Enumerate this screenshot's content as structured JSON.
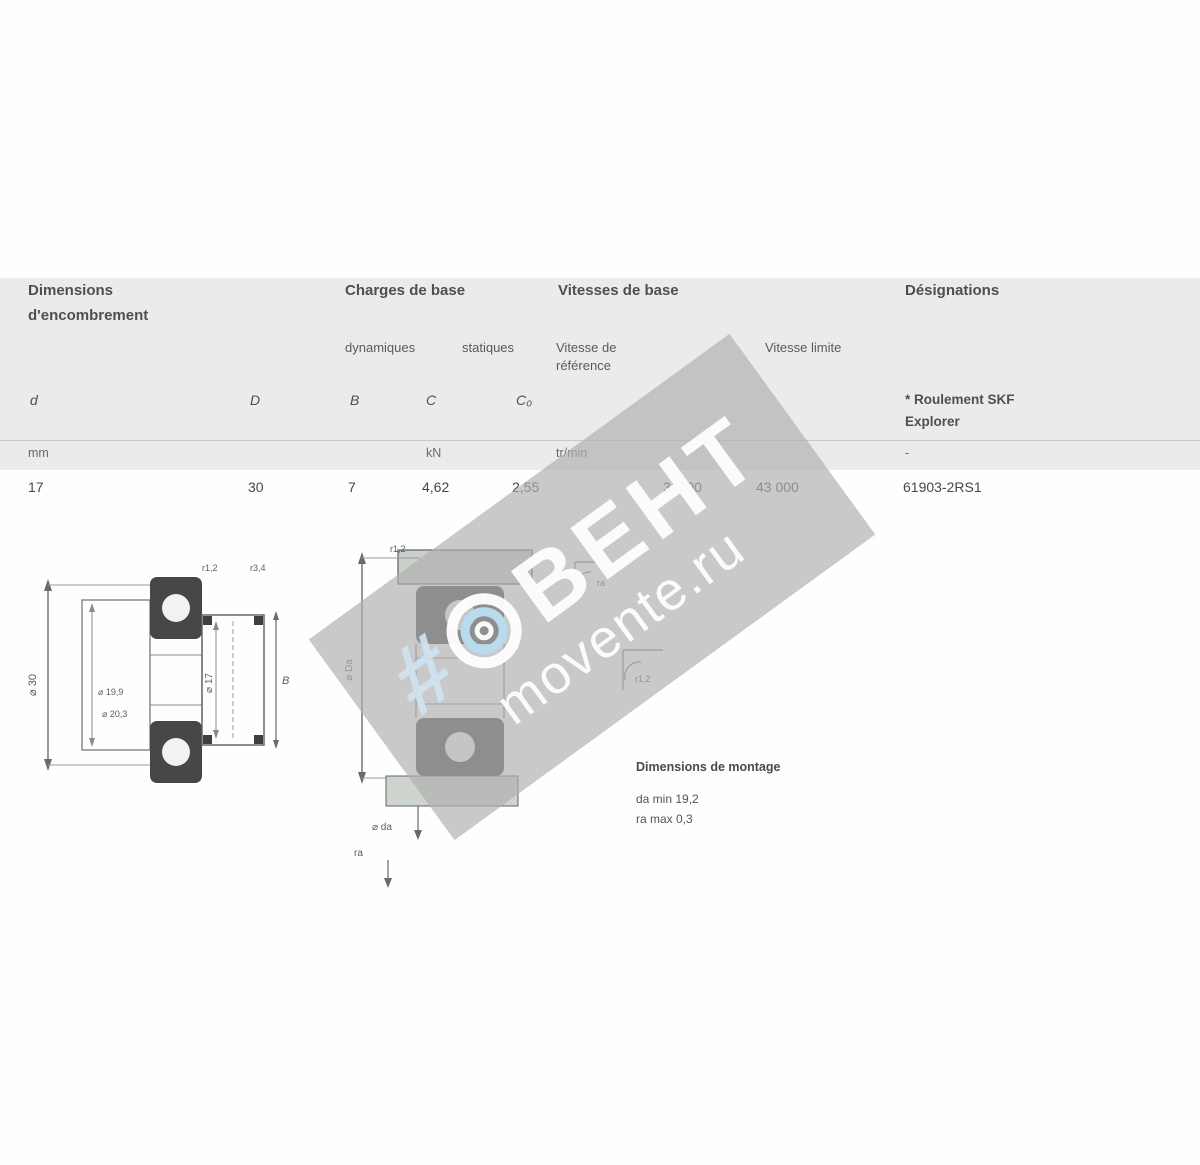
{
  "table": {
    "group_headers": {
      "dims_line1": "Dimensions",
      "dims_line2": "d'encombrement",
      "loads": "Charges de base",
      "speeds": "Vitesses de base",
      "designation": "Désignations"
    },
    "sub_headers": {
      "dynamic": "dynamiques",
      "static": "statiques",
      "ref_line1": "Vitesse de",
      "ref_line2": "référence",
      "limit": "Vitesse limite",
      "explorer_line1": "* Roulement SKF",
      "explorer_line2": "Explorer"
    },
    "symbols": {
      "d": "d",
      "D": "D",
      "B": "B",
      "C": "C",
      "C0": "C₀"
    },
    "units": {
      "mm": "mm",
      "kN": "kN",
      "rpm": "tr/min",
      "dash": "-"
    },
    "row": {
      "d": "17",
      "D": "30",
      "B": "7",
      "C": "4,62",
      "C0": "2,55",
      "ref_speed": "34000",
      "limit_speed": "43 000",
      "designation": "61903-2RS1"
    }
  },
  "drawings": {
    "left": {
      "dim_outer": "⌀ 30",
      "dim_bore": "⌀ 17",
      "dim_width": "B",
      "r_top1": "r1,2",
      "r_top2": "r3,4",
      "label_d2": "⌀ 19,9",
      "label_D2": "⌀ 20,3"
    },
    "middle": {
      "dim_housing": "⌀ Da",
      "dim_shaft": "⌀ da",
      "fillet": "ra",
      "r_top": "r1,2"
    },
    "details": {
      "r1": "ra",
      "r2": "r1,2"
    },
    "mounting": {
      "title": "Dimensions de montage",
      "line1": "da min 19,2",
      "line2": "ra max 0,3"
    }
  },
  "watermark": {
    "hash": "#",
    "brand": "ВЕНТ",
    "site": "movente.ru",
    "gray": "#afafaf",
    "blue": "#b8dcec"
  }
}
